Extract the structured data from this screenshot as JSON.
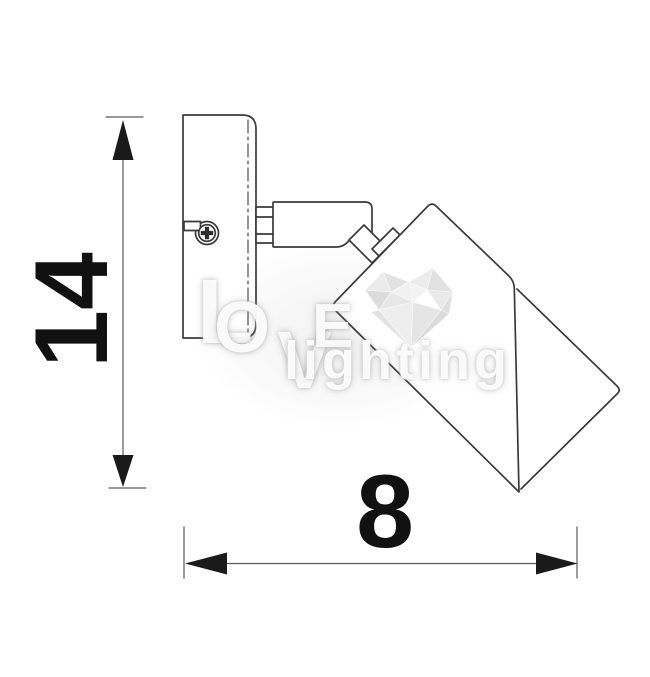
{
  "diagram": {
    "dimensions": {
      "height": {
        "label": "14"
      },
      "width": {
        "label": "8"
      }
    },
    "colors": {
      "line": "#3a3a3a",
      "thin_line": "#5a5a5a",
      "arrow_fill": "#1a1a1a",
      "label_text": "#111111"
    }
  },
  "watermark": {
    "letters": {
      "l1": "L",
      "l2": "O",
      "l3": "V",
      "l4": "E"
    },
    "word": "lighting",
    "heart_grays": [
      "#f0f0f0",
      "#e6e6e6",
      "#dcdcdc",
      "#d2d2d2"
    ]
  }
}
